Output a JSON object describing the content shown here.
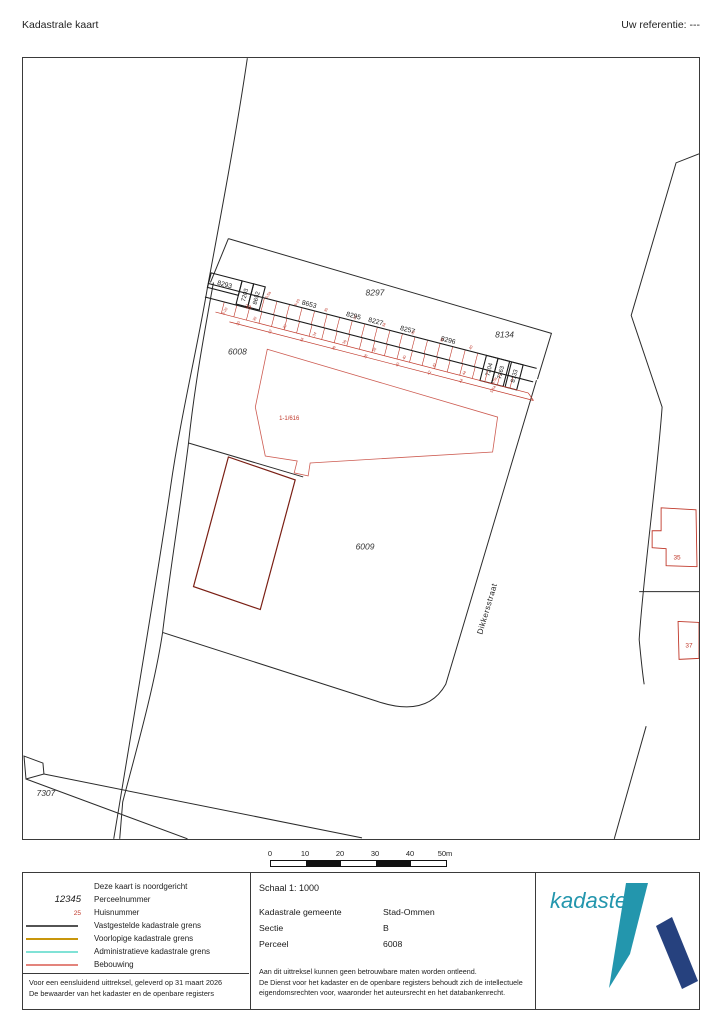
{
  "page": {
    "title": "Kadastrale kaart",
    "reference": "Uw referentie: ---"
  },
  "map": {
    "parcel_labels": [
      "8297",
      "8134",
      "6008",
      "6009",
      "7307"
    ],
    "strip_parcels": [
      "8293",
      "7203",
      "8652",
      "8653",
      "8295",
      "8227",
      "8257",
      "8296",
      "7204",
      "7263",
      "8133"
    ],
    "street": "Dikkersstraat",
    "house_numbers": [
      "3a",
      "1-1/616",
      "35",
      "37"
    ],
    "small_numbers": [
      "5,5a",
      "8-20",
      "30",
      "32",
      "34",
      "36",
      "38",
      "40",
      "42",
      "44"
    ],
    "colors": {
      "line": "#2b2b2b",
      "building_red": "#c0392b",
      "building_dark": "#7a1f14",
      "label_red": "#c0392b"
    }
  },
  "scalebar": {
    "ticks": [
      "0",
      "10",
      "20",
      "30",
      "40",
      "50m"
    ]
  },
  "info": {
    "legend": {
      "north_note": "Deze kaart is noordgericht",
      "parcel_key": "12345",
      "parcel_label": "Perceelnummer",
      "house_key": "25",
      "house_label": "Huisnummer",
      "lines": [
        {
          "color": "#1a1a1a",
          "label": "Vastgestelde kadastrale grens"
        },
        {
          "color": "#c8960c",
          "label": "Voorlopige kadastrale grens"
        },
        {
          "color": "#57d8c8",
          "label": "Administratieve kadastrale grens"
        },
        {
          "color": "#d23b2e",
          "label": "Bebouwing"
        }
      ]
    },
    "footer_line1": "Voor een eensluidend uittreksel, geleverd op 31 maart 2026",
    "footer_line2": "De bewaarder van het kadaster en de openbare registers",
    "schaal": "Schaal 1: 1000",
    "fields": [
      {
        "label": "Kadastrale gemeente",
        "value": "Stad-Ommen"
      },
      {
        "label": "Sectie",
        "value": "B"
      },
      {
        "label": "Perceel",
        "value": "6008"
      }
    ],
    "disclaimer_line1": "Aan dit uittreksel kunnen geen betrouwbare maten worden ontleend.",
    "disclaimer_line2": "De Dienst voor het kadaster en de openbare registers behoudt zich de intellectuele",
    "disclaimer_line3": "eigendomsrechten voor, waaronder het auteursrecht en het databankenrecht.",
    "logo": {
      "text": "kadaster",
      "teal": "#2396ad",
      "navy": "#26417e"
    }
  }
}
